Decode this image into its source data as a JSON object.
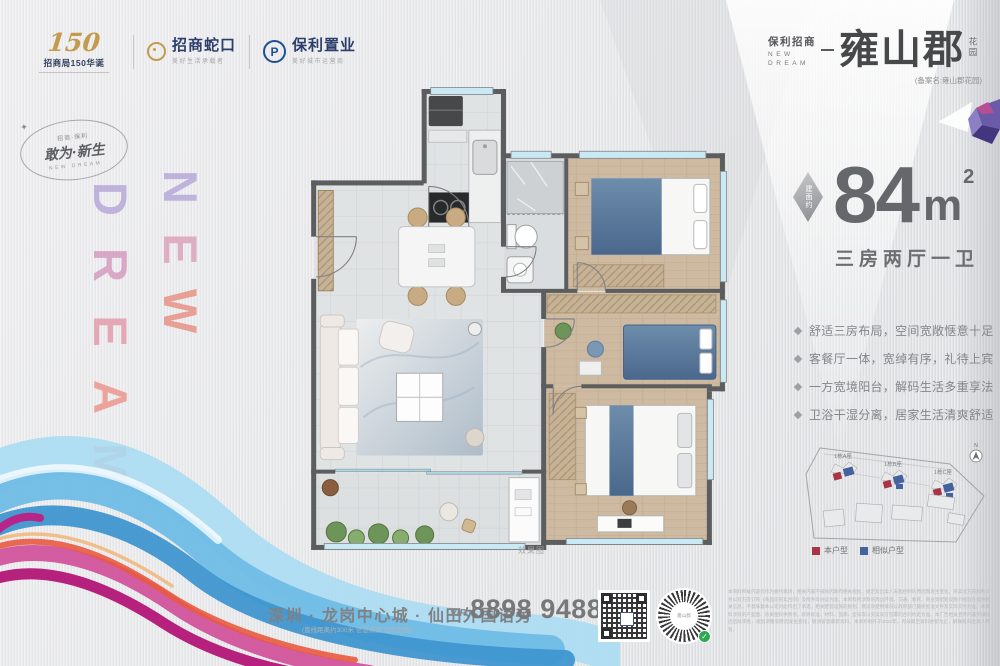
{
  "brand_bar": {
    "anniversary_number": "150",
    "anniversary_label": "招商局150华诞",
    "cmsk_name": "招商蛇口",
    "cmsk_tagline": "美好生活承载者",
    "poly_name": "保利置业",
    "poly_tagline": "美好城市运营商",
    "poly_initial": "P"
  },
  "slogan_badge": {
    "small": "招商·保利",
    "main": "敢为·新生",
    "sub": "NEW DREAM"
  },
  "vertical_art": {
    "new": [
      "N",
      "E",
      "W"
    ],
    "dream": [
      "D",
      "R",
      "E",
      "A",
      "M"
    ]
  },
  "header": {
    "brand": "保利招商",
    "brand_en_line1": "NEW",
    "brand_en_line2": "DREAM",
    "title": "雍山郡",
    "title_suffix": "花园",
    "subtitle": "(备案名:雍山郡花园)"
  },
  "area": {
    "badge": "建面约",
    "value": "84",
    "unit": "m",
    "sup": "2",
    "layout": "三房两厅一卫"
  },
  "features": [
    "舒适三房布局，空间宽敞惬意十足",
    "客餐厅一体，宽绰有序，礼待上宾",
    "一方宽境阳台，解码生活多重享法",
    "卫浴干湿分离，居家生活清爽舒适"
  ],
  "floorplan": {
    "caption": "效果图"
  },
  "siteplan": {
    "buildings": [
      "1栋A座",
      "1栋B座",
      "1栋C座"
    ],
    "north_label": "N",
    "legend": [
      {
        "label": "本户型",
        "color": "#a93445"
      },
      {
        "label": "相似户型",
        "color": "#44629f"
      }
    ]
  },
  "footer": {
    "address": "深圳 · 龙岗中心城 · 仙田外国语旁",
    "address_note": "(直线距离约300米 信息来源:百度地图)",
    "vip_label": "VIP",
    "phone": "8898 9488",
    "phone_suffix": "@163.COM",
    "wechat_center": "雍山郡",
    "disclaimer": "本资料所载内容仅作为要约邀请，相关内容不排除因政府相关规划、规定及出卖人未能控制的原因而发生变化，买卖双方的权利义务以双方签订的《商品房买卖合同》及附件等协议为准。本资料所涉及的周边环境、交通、教育、商业等配套设施介绍旨在提供相关信息，不意味着本公司对此作出了承诺，相关配套设施的规划、建设及使用情况以政府部门最终批准文件及实际交付为准。本资料涉及的户型图、效果图仅供参考，装修标准、材料、品牌、型号等以买卖双方签署的合同约定为准。本广告相关宣传内容不排除因后续审批、规划调整等原因发生变化，敬请留意最新资料。本资料制作于2022年，有效期至资料更新为止，解释权归出卖人所有。"
  }
}
